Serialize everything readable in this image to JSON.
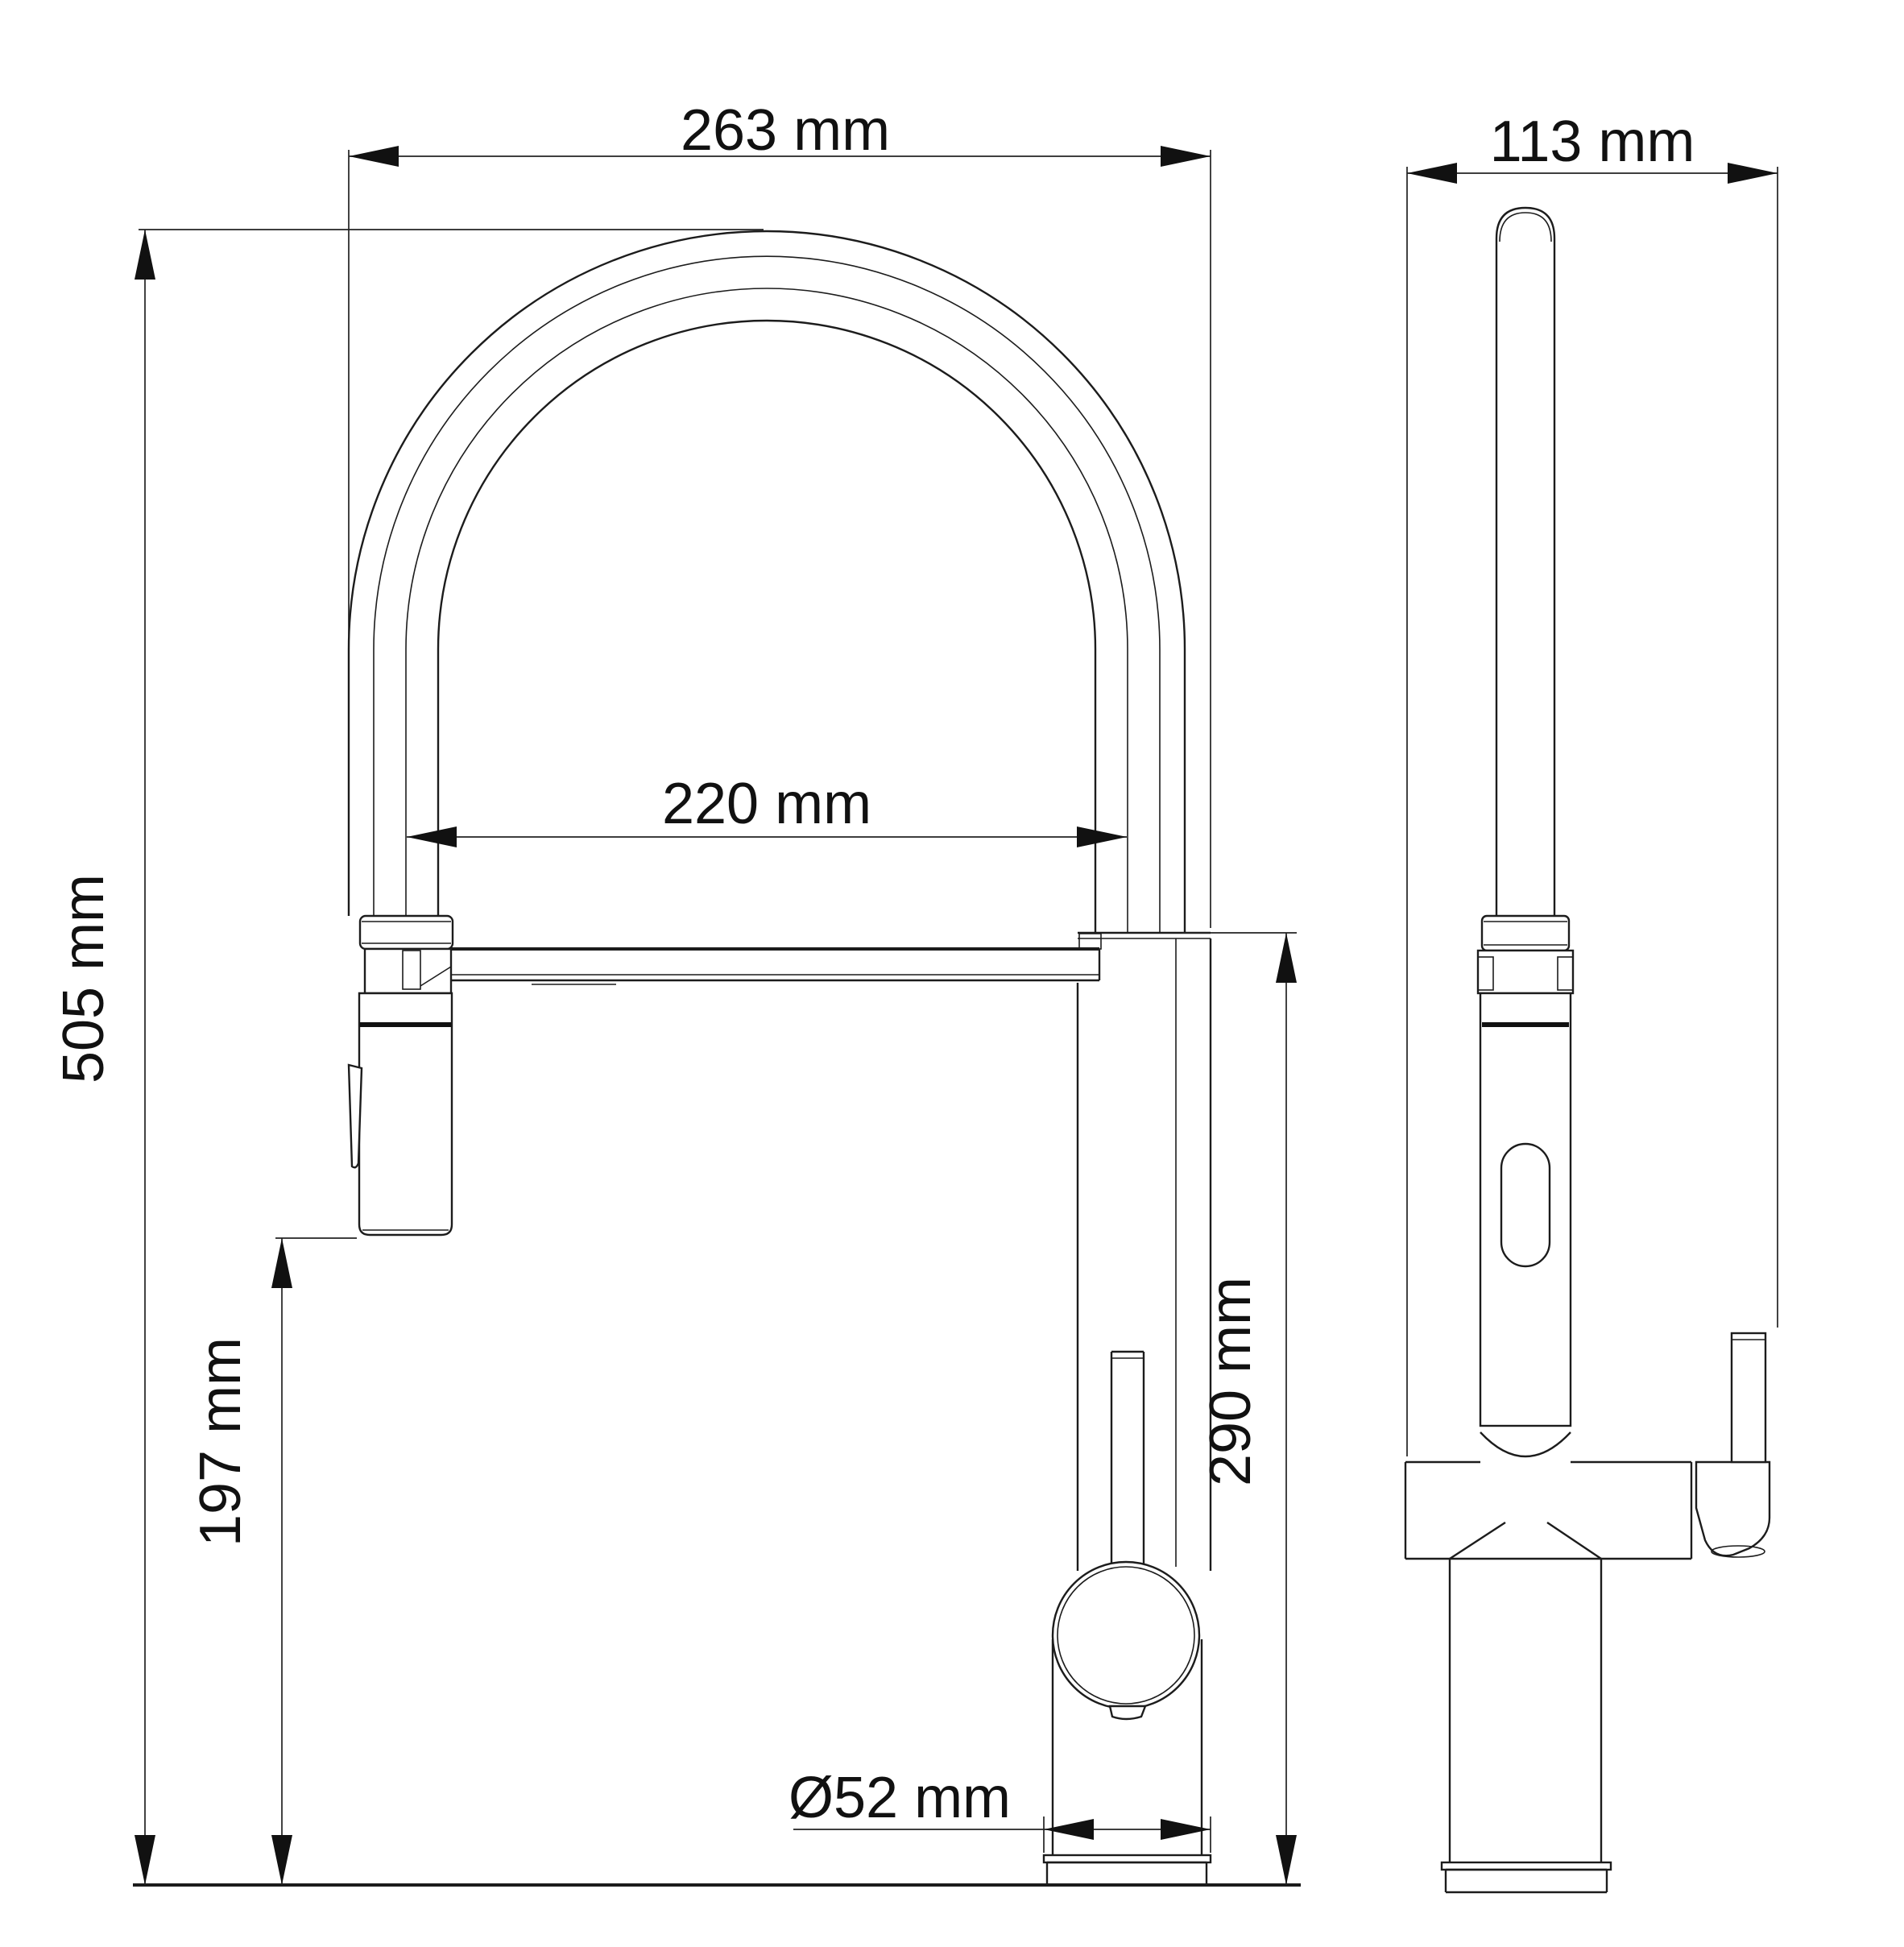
{
  "drawing": {
    "type": "technical-dimension-drawing",
    "subject": "kitchen-faucet-two-views",
    "labels": {
      "overall_width": "263 mm",
      "side_depth": "113 mm",
      "spout_reach": "220 mm",
      "total_height": "505 mm",
      "head_clearance": "197 mm",
      "spout_height": "290 mm",
      "base_diameter": "Ø52 mm"
    }
  }
}
